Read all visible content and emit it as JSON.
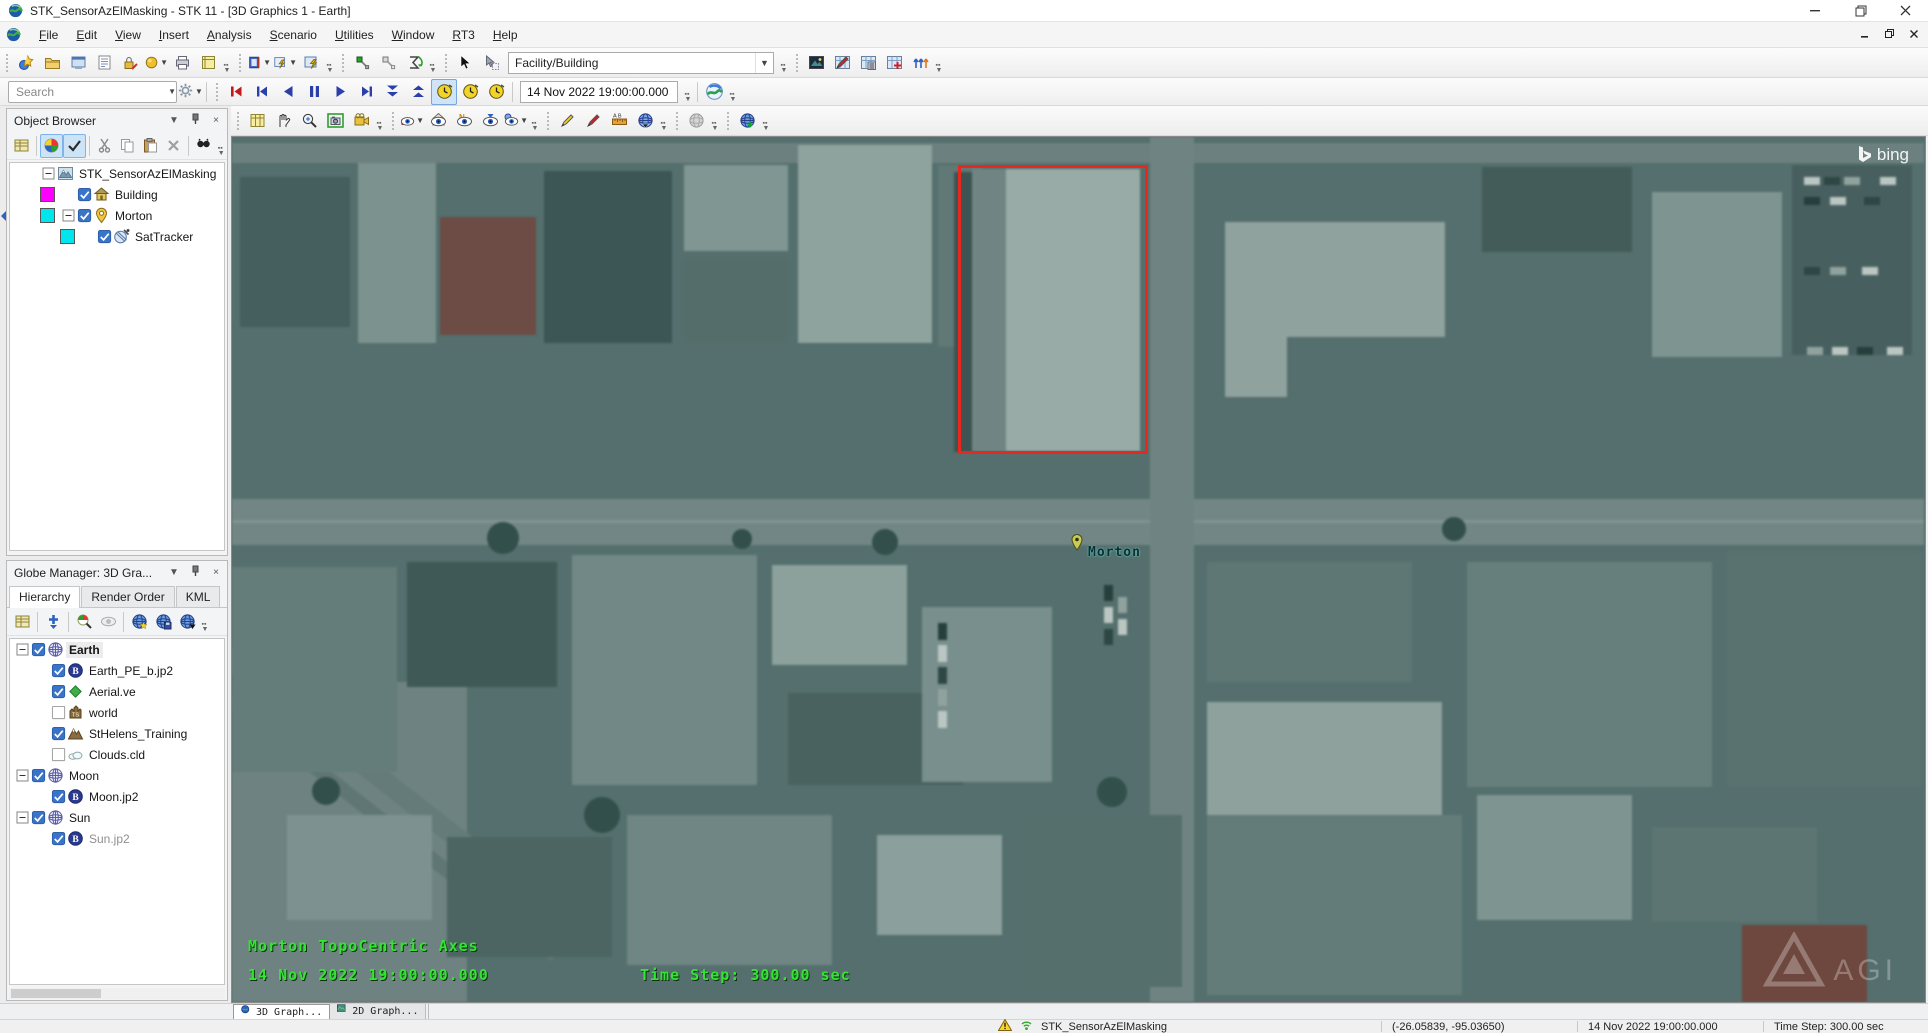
{
  "window": {
    "title": "STK_SensorAzElMasking - STK 11 - [3D Graphics 1 - Earth]",
    "menus": [
      "File",
      "Edit",
      "View",
      "Insert",
      "Analysis",
      "Scenario",
      "Utilities",
      "Window",
      "RT3",
      "Help"
    ],
    "app_icon": "stk-globe-icon"
  },
  "main_toolbar": [
    {
      "buttons": [
        {
          "n": "new-scenario"
        },
        {
          "n": "open-scenario"
        },
        {
          "n": "save-viewer-form"
        },
        {
          "n": "report-manager"
        },
        {
          "n": "access-tool"
        },
        {
          "n": "globe-options",
          "dd": true
        },
        {
          "n": "print"
        },
        {
          "n": "html-viewer"
        }
      ]
    },
    {
      "buttons": [
        {
          "n": "report-style",
          "dd": true
        },
        {
          "n": "graph-style",
          "dd": true
        },
        {
          "n": "strip-chart"
        }
      ]
    },
    {
      "buttons": [
        {
          "n": "link-node"
        },
        {
          "n": "chain-node"
        },
        {
          "n": "dynamic-display"
        }
      ]
    },
    {
      "buttons": [
        {
          "n": "select-cursor"
        },
        {
          "n": "pick-cursor"
        }
      ],
      "combo": "Facility/Building"
    },
    {
      "buttons": [
        {
          "n": "image-snap"
        },
        {
          "n": "table-edit"
        },
        {
          "n": "table-view"
        },
        {
          "n": "table-add"
        },
        {
          "n": "timeline-tool"
        }
      ]
    }
  ],
  "search": {
    "placeholder": "Search",
    "icons": [
      "search-icon",
      "gear-icon"
    ]
  },
  "animation": {
    "buttons": [
      {
        "n": "animation-reset"
      },
      {
        "n": "animation-step-reverse"
      },
      {
        "n": "animation-play-reverse"
      },
      {
        "n": "animation-pause"
      },
      {
        "n": "animation-play"
      },
      {
        "n": "animation-step-forward"
      },
      {
        "n": "animation-decrease-step"
      },
      {
        "n": "animation-increase-step"
      }
    ],
    "clocks": [
      {
        "n": "clock-realtime",
        "selected": true
      },
      {
        "n": "clock-time"
      },
      {
        "n": "clock-step"
      }
    ],
    "time_value": "14 Nov 2022 19:00:00.000",
    "sync_icon": "globe-sync-icon"
  },
  "view_toolbar": [
    {
      "buttons": [
        {
          "n": "view-properties"
        },
        {
          "n": "pan-tool"
        },
        {
          "n": "zoom-tool"
        },
        {
          "n": "snap-frame"
        },
        {
          "n": "record-movie"
        }
      ]
    },
    {
      "buttons": [
        {
          "n": "view-from",
          "dd": true
        },
        {
          "n": "home-view"
        },
        {
          "n": "view-north"
        },
        {
          "n": "view-nadir"
        },
        {
          "n": "view-planet",
          "dd": true
        }
      ]
    },
    {
      "buttons": [
        {
          "n": "draw-marker"
        },
        {
          "n": "draw-pen"
        },
        {
          "n": "measure-tool"
        },
        {
          "n": "globe-picker"
        }
      ]
    },
    {
      "buttons": [
        {
          "n": "globe-disabled"
        }
      ]
    },
    {
      "buttons": [
        {
          "n": "globe-import"
        }
      ]
    }
  ],
  "object_browser": {
    "title": "Object Browser",
    "header_icons": [
      "dropdown-icon",
      "pin-icon",
      "close-icon"
    ],
    "toolbar": [
      {
        "n": "report-grid",
        "sep": true
      },
      {
        "n": "color-wheel",
        "pressed": true
      },
      {
        "n": "filter-check",
        "pressed": true,
        "sep": true
      },
      {
        "n": "cut"
      },
      {
        "n": "copy"
      },
      {
        "n": "paste"
      },
      {
        "n": "delete",
        "sep": true
      },
      {
        "n": "find"
      }
    ],
    "tree": [
      {
        "label": "STK_SensorAzElMasking",
        "icon": "scenario",
        "level": 0,
        "expand": true
      },
      {
        "label": "Building",
        "icon": "building",
        "level": 1,
        "checked": true,
        "swatch": "#ff00ff"
      },
      {
        "label": "Morton",
        "icon": "place",
        "level": 1,
        "checked": true,
        "expand": true,
        "swatch": "#00e5ee"
      },
      {
        "label": "SatTracker",
        "icon": "sensor",
        "level": 2,
        "checked": true,
        "swatch": "#00e5ee"
      }
    ]
  },
  "globe_manager": {
    "title": "Globe Manager: 3D Gra...",
    "header_icons": [
      "dropdown-icon",
      "pin-icon",
      "close-icon"
    ],
    "tabs": [
      {
        "label": "Hierarchy",
        "active": true
      },
      {
        "label": "Render Order"
      },
      {
        "label": "KML"
      }
    ],
    "toolbar": [
      {
        "n": "report-grid",
        "sep": true
      },
      {
        "n": "add-item",
        "sep": true
      },
      {
        "n": "search-imagery"
      },
      {
        "n": "hide-item",
        "sep": true
      },
      {
        "n": "globe-add"
      },
      {
        "n": "globe-save"
      },
      {
        "n": "globe-down"
      }
    ],
    "tree": [
      {
        "label": "Earth",
        "icon": "globe",
        "level": 0,
        "expand": true,
        "checked": true,
        "bold": true
      },
      {
        "label": "Earth_PE_b.jp2",
        "icon": "bing",
        "level": 1,
        "checked": true
      },
      {
        "label": "Aerial.ve",
        "icon": "diamond",
        "level": 1,
        "checked": true
      },
      {
        "label": "world",
        "icon": "world",
        "level": 1,
        "checked": false
      },
      {
        "label": "StHelens_Training",
        "icon": "mountain",
        "level": 1,
        "checked": true
      },
      {
        "label": "Clouds.cld",
        "icon": "cloud",
        "level": 1,
        "checked": false
      },
      {
        "label": "Moon",
        "icon": "globe",
        "level": 0,
        "expand": true,
        "checked": true
      },
      {
        "label": "Moon.jp2",
        "icon": "bing",
        "level": 1,
        "checked": true
      },
      {
        "label": "Sun",
        "icon": "globe",
        "level": 0,
        "expand": true,
        "checked": true
      },
      {
        "label": "Sun.jp2",
        "icon": "bing",
        "level": 1,
        "checked": true,
        "muted": true
      }
    ]
  },
  "map": {
    "provider_logo": "bing",
    "agi_logo": "AGI",
    "marker_label": "Morton",
    "highlight_color": "#e8281e",
    "overlay": {
      "axes": "Morton TopoCentric Axes",
      "time": "14 Nov 2022 19:00:00.000",
      "step": "Time Step: 300.00 sec"
    }
  },
  "bottom_tabs": [
    {
      "label": "3D Graph...",
      "icon": "tab-3d-icon",
      "active": true
    },
    {
      "label": "2D Graph...",
      "icon": "tab-2d-icon",
      "active": false
    }
  ],
  "status_bar": {
    "icons": [
      "warning-icon",
      "signal-icon"
    ],
    "scenario": "STK_SensorAzElMasking",
    "coords": "(-26.05839, -95.03650)",
    "time": "14 Nov 2022 19:00:00.000",
    "step": "Time Step: 300.00 sec"
  }
}
